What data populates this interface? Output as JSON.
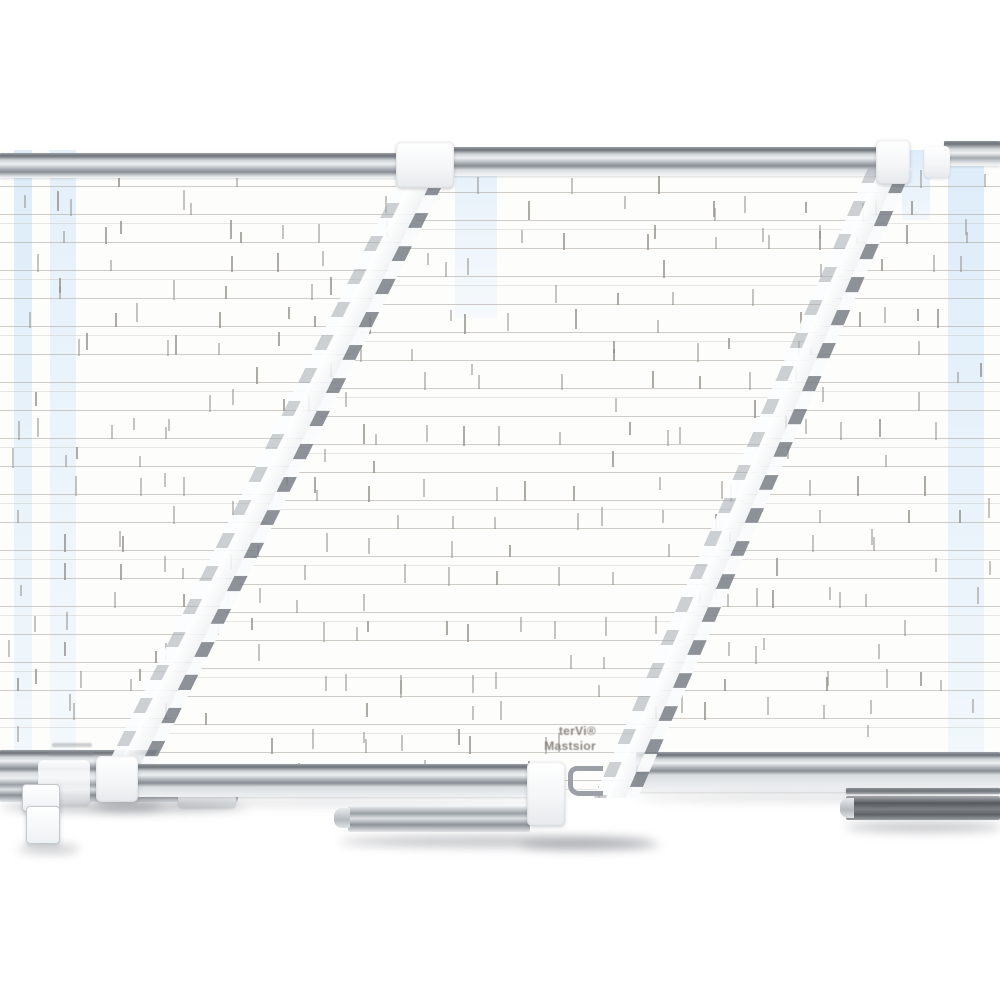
{
  "scene": {
    "background_color": "#ffffff",
    "subject": "overlapping magnetic dry-erase planning boards with aluminum frames and marker trays"
  },
  "product": {
    "front_board_logo": {
      "line1": "terVi®",
      "line2": "Mastsior"
    },
    "colors": {
      "frame_silver_light": "#f2f4f6",
      "frame_silver_mid": "#aab0b6",
      "frame_silver_dark": "#6e737a",
      "grid_line": "#a9a49d",
      "grid_tick": "#8f8b84",
      "tray_dark": "#565a5f",
      "blue_tint": "#d6eafa",
      "logo_text": "#8a857e",
      "shadow": "rgba(96,101,107,0.38)"
    }
  }
}
